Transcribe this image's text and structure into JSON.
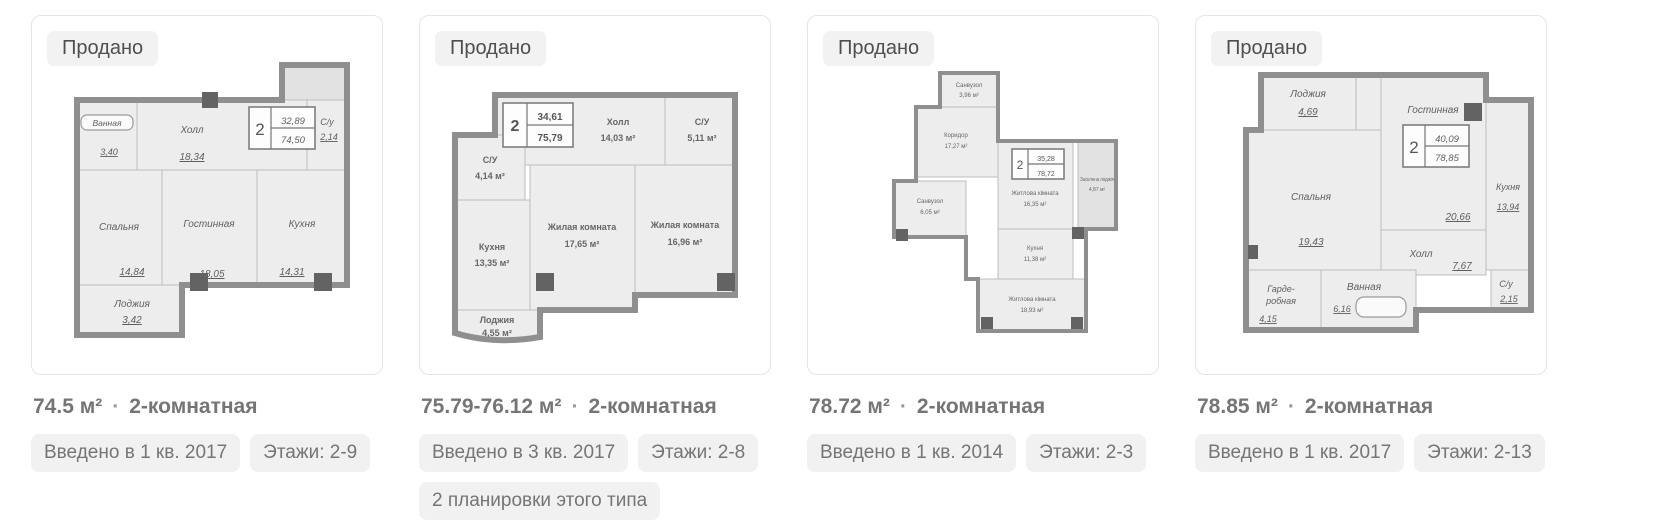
{
  "colors": {
    "card_border": "#e5e5e5",
    "badge_bg": "#f2f2f2",
    "badge_text": "#4f4f4f",
    "title_text": "#757575",
    "tag_bg": "#f1f1f1",
    "tag_text": "#757575",
    "plan_wall": "#8f8f8f",
    "room_fill": "#ededed"
  },
  "cards": [
    {
      "badge": "Продано",
      "title": "74.5 м²",
      "dot": "·",
      "type": "2-комнатная",
      "tags": [
        "Введено в 1 кв. 2017",
        "Этажи: 2-9"
      ],
      "plan": {
        "stamp": {
          "rooms": "2",
          "living": "32,89",
          "total": "74,50"
        },
        "rooms": {
          "vannaya": {
            "name": "Ванная",
            "area": "3,40"
          },
          "holl": {
            "name": "Холл",
            "area": "18,34"
          },
          "su": {
            "name": "С/у",
            "area": "2,14"
          },
          "spalnya": {
            "name": "Спальня",
            "area": "14,84"
          },
          "gostinnaya": {
            "name": "Гостинная",
            "area": "18,05"
          },
          "kuhnya": {
            "name": "Кухня",
            "area": "14,31"
          },
          "lodzhiya": {
            "name": "Лоджия",
            "area": "3,42"
          }
        }
      }
    },
    {
      "badge": "Продано",
      "title": "75.79-76.12 м²",
      "dot": "·",
      "type": "2-комнатная",
      "tags": [
        "Введено в 3 кв. 2017",
        "Этажи: 2-8",
        "2 планировки этого типа"
      ],
      "plan": {
        "stamp": {
          "rooms": "2",
          "living": "34,61",
          "total": "75,79"
        },
        "rooms": {
          "holl": {
            "name": "Холл",
            "area": "14,03 м²"
          },
          "su_top": {
            "name": "С/У",
            "area": "5,11 м²"
          },
          "su_left": {
            "name": "С/У",
            "area": "4,14 м²"
          },
          "kuhnya": {
            "name": "Кухня",
            "area": "13,35 м²"
          },
          "room1": {
            "name": "Жилая комната",
            "area": "17,65 м²"
          },
          "room2": {
            "name": "Жилая комната",
            "area": "16,96 м²"
          },
          "lodzhiya": {
            "name": "Лоджия",
            "area": "4,55 м²"
          }
        }
      }
    },
    {
      "badge": "Продано",
      "title": "78.72 м²",
      "dot": "·",
      "type": "2-комнатная",
      "tags": [
        "Введено в 1 кв. 2014",
        "Этажи: 2-3"
      ],
      "plan": {
        "stamp": {
          "rooms": "2",
          "living": "35,28",
          "total": "78,72"
        },
        "rooms": {
          "sanvuzol_top": {
            "name": "Санвузол",
            "area": "3,96 м²"
          },
          "koridor": {
            "name": "Коридор",
            "area": "17,27 м²"
          },
          "sanvuzol_left": {
            "name": "Санвузол",
            "area": "6,05 м²"
          },
          "room1": {
            "name": "Житлова кімната",
            "area": "16,35 м²"
          },
          "lodzhiya": {
            "name": "Засклена лоджія",
            "area": "4,87 м²"
          },
          "kuhnya": {
            "name": "Кухня",
            "area": "11,38 м²"
          },
          "room2": {
            "name": "Житлова кімната",
            "area": "18,93 м²"
          }
        }
      }
    },
    {
      "badge": "Продано",
      "title": "78.85 м²",
      "dot": "·",
      "type": "2-комнатная",
      "tags": [
        "Введено в 1 кв. 2017",
        "Этажи: 2-13"
      ],
      "plan": {
        "stamp": {
          "rooms": "2",
          "living": "40,09",
          "total": "78,85"
        },
        "rooms": {
          "lodzhiya": {
            "name": "Лоджия",
            "area": "4,69"
          },
          "gostinnaya": {
            "name": "Гостинная",
            "area": "20,66"
          },
          "spalnya": {
            "name": "Спальня",
            "area": "19,43"
          },
          "kuhnya": {
            "name": "Кухня",
            "area": "13,94"
          },
          "holl": {
            "name": "Холл",
            "area": "7,67"
          },
          "su": {
            "name": "С/у",
            "area": "2,15"
          },
          "garderobnaya": {
            "name_l1": "Гарде-",
            "name_l2": "робная",
            "area": "4,15"
          },
          "vannaya": {
            "name": "Ванная",
            "area": "6,16"
          }
        }
      }
    }
  ]
}
